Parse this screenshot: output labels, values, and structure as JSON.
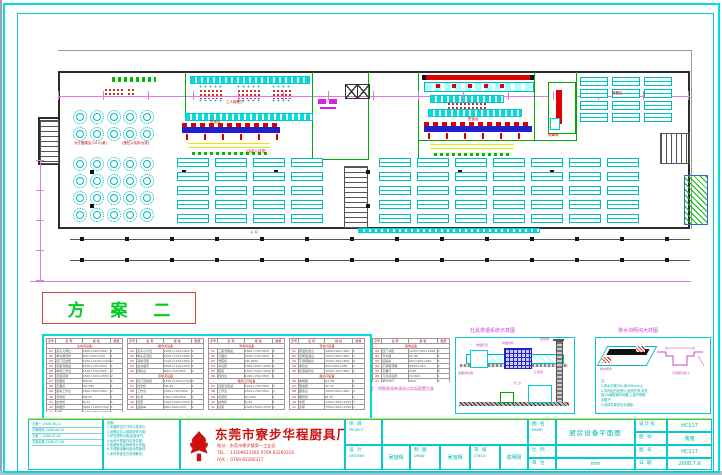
{
  "plan": {
    "scheme_title": "方 案 二",
    "labels": {
      "hall_note1": "大厅圆桌区(10人/桌)",
      "hall_note2": "(摆位以实际为准)",
      "staff_hall": "工人就餐厅",
      "entry_mid": "(由此入口进)",
      "serving_left": "售饭台",
      "serving_right": "售饭台",
      "disinfect": "消毒间",
      "ne_area": "就餐区",
      "entrance": "入 口"
    }
  },
  "equipment_tables": {
    "columns": [
      "序号",
      "名 称",
      "规 格",
      "数量"
    ],
    "caption": "注：明细表如有改动以实际配置为准",
    "tables": [
      {
        "title": "主食间设备",
        "rows": [
          [
            "01",
            "双头大锅灶",
            "1800×900×800",
            "1"
          ],
          [
            "02",
            "单头矮汤炉",
            "600×600×450",
            "1"
          ],
          [
            "03",
            "四门蒸饭柜",
            "1220×1100×1920",
            "2"
          ],
          [
            "04",
            "双星洗刷盆",
            "1200×700×800",
            "1"
          ],
          [
            "05",
            "单通工作台",
            "1500×700×800",
            "2"
          ],
          [
            "06",
            "四层货架",
            "1500×500×1550",
            "2"
          ],
          [
            "07",
            "和面机",
            "HM-50",
            "1"
          ],
          [
            "08",
            "压面机",
            "YM-350",
            "1"
          ],
          [
            "09",
            "面案工作台",
            "1800×800×800",
            "2"
          ],
          [
            "10",
            "洗米机",
            "XM-50",
            "1"
          ],
          [
            "11",
            "绞肉机",
            "TJ-12",
            "1"
          ],
          [
            "12",
            "排烟罩",
            "3600×1000×500",
            "1"
          ],
          [
            "13",
            "冰柜",
            "1200×760×1950",
            "1"
          ]
        ]
      },
      {
        "title": "副食间设备",
        "rows": [
          [
            "01",
            "双头小炒灶",
            "2400×1150×800",
            "2"
          ],
          [
            "02",
            "单头吊汤灶",
            "1200×1150×800",
            "1"
          ],
          [
            "03",
            "海鲜蒸柜",
            "1100×1150×800",
            "1"
          ],
          [
            "04",
            "运水烟罩",
            "5400×1100×500",
            "1"
          ],
          [
            "05",
            "调料台",
            "800×700×800",
            "2"
          ],
          [
            "蒸饭间设备"
          ],
          [
            "06",
            "双门蒸饭柜",
            "1450×1100×1920",
            "2"
          ],
          [
            "07",
            "洗米机",
            "XM-50",
            "1"
          ],
          [
            "08",
            "工作台",
            "1500×700×800",
            "1"
          ],
          [
            "09",
            "水池",
            "700×700×800",
            "1"
          ],
          [
            "10",
            "货架",
            "1500×500×1550",
            "1"
          ],
          [
            "11",
            "运输车",
            "600×900×950",
            "2"
          ]
        ]
      },
      {
        "title": "洗消间设备",
        "rows": [
          [
            "01",
            "三星洗刷盆",
            "1800×700×800",
            "2"
          ],
          [
            "02",
            "污碟台",
            "1200×700×800",
            "1"
          ],
          [
            "03",
            "洗碗机",
            "CM-2000",
            "1"
          ],
          [
            "04",
            "消毒柜",
            "1380×650×1900",
            "2"
          ],
          [
            "05",
            "碗柜",
            "1500×500×1800",
            "2"
          ],
          [
            "06",
            "残食台",
            "1000×700×800",
            "1"
          ],
          [
            "粗加工间设备"
          ],
          [
            "07",
            "双星洗菜盆",
            "1200×700×800",
            "2"
          ],
          [
            "08",
            "工作台",
            "1500×700×800",
            "2"
          ],
          [
            "09",
            "切菜机",
            "QC-660",
            "1"
          ],
          [
            "10",
            "绞肉机",
            "TJ-22",
            "1"
          ],
          [
            "11",
            "货架",
            "1500×500×1550",
            "2"
          ]
        ]
      },
      {
        "title": "售饭间设备",
        "rows": [
          [
            "01",
            "保温售饭台",
            "1800×900×800",
            "4"
          ],
          [
            "02",
            "汤粥保温台",
            "1200×900×800",
            "2"
          ],
          [
            "03",
            "不锈钢餐台",
            "1500×700×800",
            "6"
          ],
          [
            "04",
            "收款台",
            "600×600×950",
            "2"
          ],
          [
            "05",
            "奶茶操作台",
            "1500×700×800",
            "1"
          ],
          [
            "面点间设备"
          ],
          [
            "06",
            "电烤箱",
            "KX-3B",
            "1"
          ],
          [
            "07",
            "醒发箱",
            "XF-32",
            "1"
          ],
          [
            "08",
            "面案台",
            "1800×800×800",
            "2"
          ],
          [
            "09",
            "搅拌机",
            "JB-30",
            "1"
          ],
          [
            "10",
            "冰柜",
            "1200×760×1950",
            "1"
          ],
          [
            "11",
            "货架",
            "1500×500×1550",
            "1"
          ]
        ]
      },
      {
        "title": "其他设备",
        "rows": [
          [
            "01",
            "四门冰柜",
            "1220×760×1950",
            "2"
          ],
          [
            "02",
            "开水器",
            "KS-90",
            "2"
          ],
          [
            "03",
            "运输车",
            "600×900×950",
            "4"
          ],
          [
            "04",
            "不锈钢汤桶",
            "Φ450×450",
            "6"
          ],
          [
            "05",
            "灭蝇灯",
            "20W",
            "8"
          ],
          [
            "06",
            "刀具消毒柜",
            "DX-800",
            "1"
          ],
          [
            "07",
            "紫外线灯",
            "30W",
            "6"
          ],
          [
            "08",
            "挂墙层架",
            "1500×300",
            "6"
          ],
          [
            "09",
            "水池",
            "600×600×800",
            "2"
          ]
        ]
      }
    ]
  },
  "details": [
    {
      "title": "灶具排烟系统示意图",
      "labels": [
        "油烟净化器",
        "排烟风机",
        "防雨帽",
        "排烟管道",
        "止回阀",
        "灶 台"
      ]
    },
    {
      "title": "排水沟明沟大样图",
      "iso_label": "排水明沟",
      "sect_label": "不锈钢沟篦子",
      "notes": [
        "注:",
        "1.排水沟宽300,深250(mm);",
        "2.沟内贴白色瓷片,面须光滑,沟底",
        "  找1%坡度坡向地漏,上盖不锈钢",
        "  沟篦子;",
        "3.具体位置详见平面图。"
      ]
    }
  ],
  "titleblock": {
    "revisions": [
      "方案一  2008.06.12",
      "方案修改 2008.06.25",
      "方案二  2008.07.02",
      "方案定稿 2008.07.06"
    ],
    "notes": [
      "说明:",
      "1.本图所注尺寸均以毫米计;",
      "2.设备定位以现场放样为准;",
      "3.炉灶燃料为柴油/液化气;",
      "4.水电气预留详见条件图;",
      "5.排烟系统由我司设计安装;",
      "6.不锈钢设备均用优质板材;",
      "7.未尽事宜双方协商解决。"
    ],
    "company": {
      "name": "东莞市寮步华程厨具厂",
      "addr": "地址：东莞市寮步镇第一工业区",
      "tel": "TEL ：13509611282  0769 83260316",
      "fax": "FAX ：0769 83260317"
    },
    "fields": {
      "project_label": "项 目",
      "project_en": "PROJECT:",
      "project_value": "",
      "design_label": "设 计",
      "design_en": "DESIGNE:",
      "designer": "吴旭辉",
      "draw_label": "制 图",
      "draw_en": "DRAW:",
      "drafter": "吴旭辉",
      "check_label": "审 核",
      "check_en": "CHECK:",
      "checker": "成明阳",
      "name_label": "图 名",
      "name_en": "NAME:",
      "drawing_name": "厨房设备平面图",
      "scale_label": "比 例",
      "scale_value": "",
      "unit_label": "单 位",
      "unit_value": "mm",
      "design_no_label": "设计号",
      "design_no": "HC117",
      "category_label": "图 别",
      "category": "装施",
      "sheet_no_label": "图 号",
      "sheet_no": "HC117",
      "date_label": "日 期",
      "date": "2008.7.6"
    }
  }
}
